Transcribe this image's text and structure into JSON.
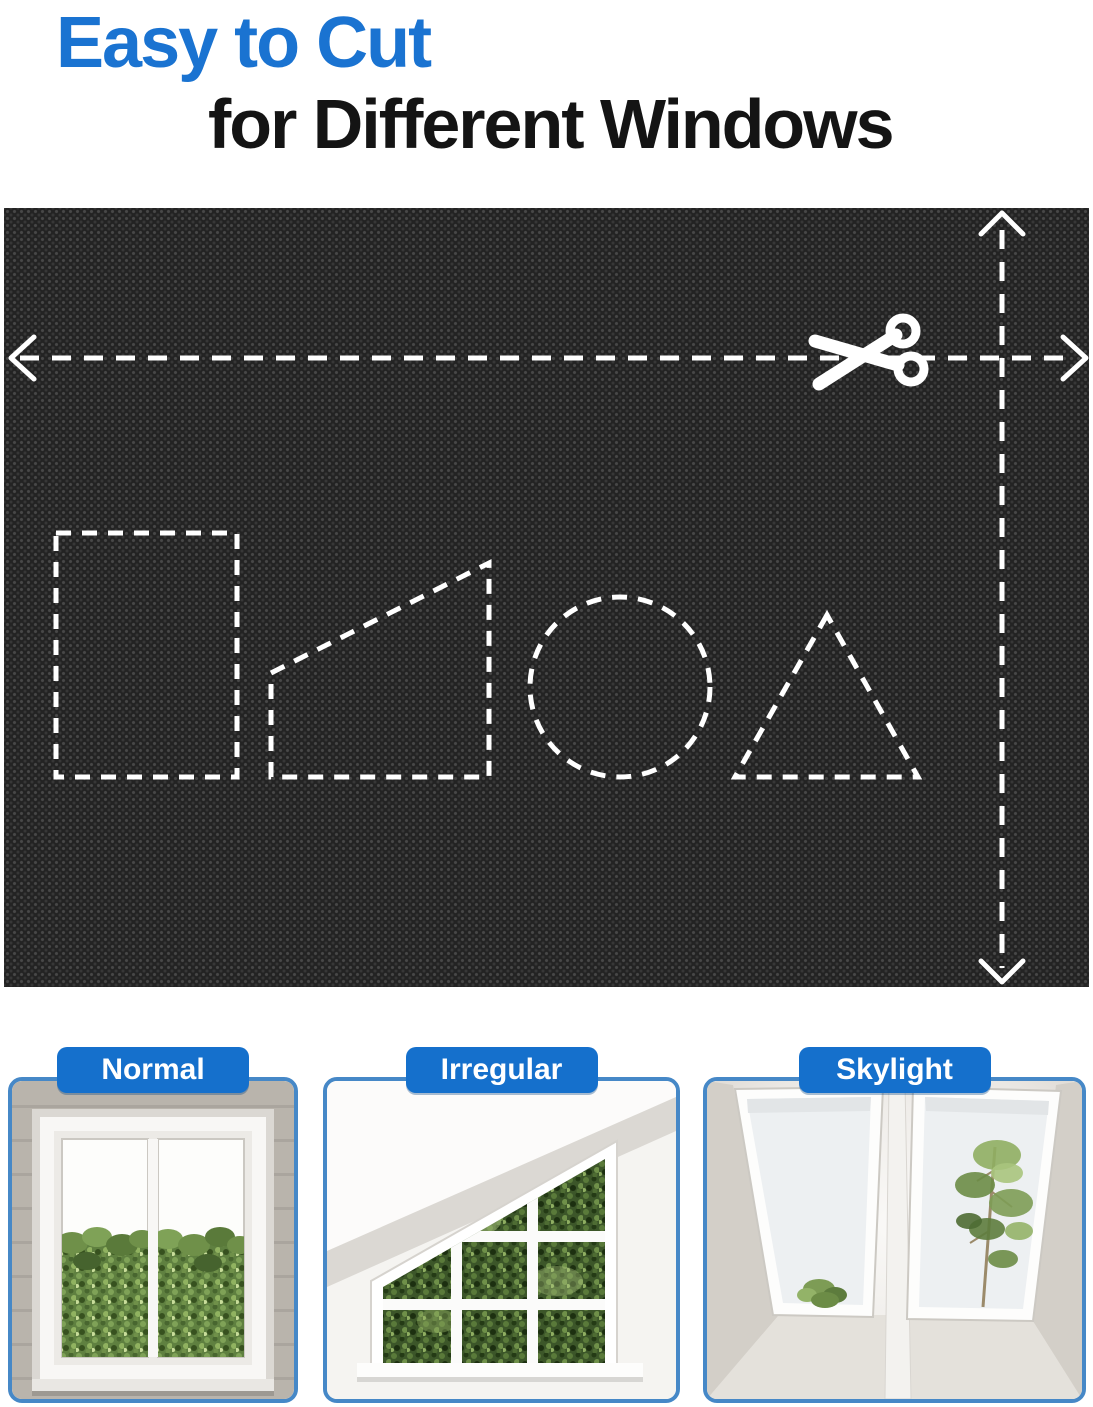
{
  "heading": {
    "line1": "Easy to Cut",
    "line2": "for Different Windows"
  },
  "fabric_panel": {
    "cut_shapes": [
      "rectangle",
      "trapezoid",
      "circle",
      "triangle"
    ],
    "icons": [
      "scissors-icon",
      "horizontal-cut-arrow-line",
      "vertical-cut-arrow-line"
    ]
  },
  "cards": [
    {
      "label": "Normal"
    },
    {
      "label": "Irregular"
    },
    {
      "label": "Skylight"
    }
  ],
  "colors": {
    "accent_blue": "#1a73d1",
    "label_blue": "#1570cc",
    "card_border_blue": "#4688c7",
    "heading_black": "#141414",
    "fabric_black": "#232323",
    "guide_white": "#ffffff"
  }
}
